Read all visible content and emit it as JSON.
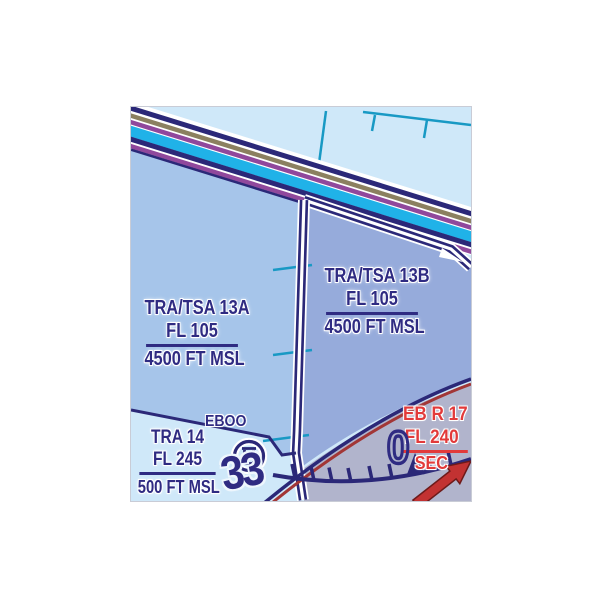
{
  "chart": {
    "kind": "VFR aeronautical chart excerpt",
    "colors": {
      "background_light": "#cfe8f9",
      "tra_tsa_13a_fill": "#a6c5ea",
      "tra_tsa_13b_fill": "#96abdb",
      "restricted_fill": "#b1b4cc",
      "boundary_navy": "#2b2878",
      "label_navy": "#2f2b82",
      "restricted_red": "#e23a3a",
      "restricted_arc_red": "#a23636",
      "band_cyan": "#20b2e8",
      "band_olive": "#8b8060",
      "band_purple": "#90489c",
      "graticule_teal": "#1899c4"
    }
  },
  "airspaces": [
    {
      "id": "tra-tsa-13a",
      "name": "TRA/TSA 13A",
      "upper_limit": "FL 105",
      "lower_limit": "4500 FT MSL"
    },
    {
      "id": "tra-tsa-13b",
      "name": "TRA/TSA 13B",
      "upper_limit": "FL 105",
      "lower_limit": "4500 FT MSL"
    },
    {
      "id": "tra-14",
      "name": "TRA 14",
      "upper_limit": "FL 245",
      "lower_limit": "500 FT MSL"
    }
  ],
  "restricted_area": {
    "name": "EB R 17",
    "upper_limit": "FL 240",
    "note": "SEC"
  },
  "airfield": {
    "code": "EBOO",
    "symbol": "heliport"
  },
  "compass_rose": {
    "numerals": [
      "33",
      "0"
    ]
  }
}
